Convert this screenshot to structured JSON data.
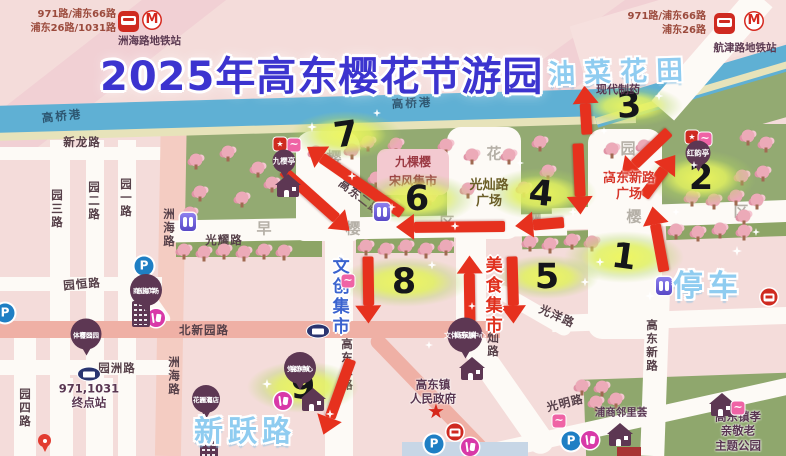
{
  "header": {
    "title": "2025年高东樱花节游园",
    "overlay_title": "油菜花田",
    "factory": "现代制药",
    "left_transit": {
      "line1": "971路/浦东66路",
      "line2": "浦东26路/1031路",
      "station": "洲海路地铁站"
    },
    "right_transit": {
      "line1": "971路/浦东66路",
      "line2": "浦东26路",
      "station": "航津路地铁站"
    }
  },
  "map": {
    "big_labels": [
      {
        "text": "停车",
        "x": 708,
        "y": 283,
        "size": 30
      },
      {
        "text": "新跃路",
        "x": 245,
        "y": 429,
        "size": 29
      }
    ],
    "river_labels": [
      {
        "text": "高桥港",
        "x": 62,
        "y": 116,
        "rot": -6
      },
      {
        "text": "高桥港",
        "x": 412,
        "y": 103,
        "rot": -3
      }
    ],
    "road_labels": [
      {
        "text": "新龙路",
        "x": 82,
        "y": 142
      },
      {
        "text": "园三路",
        "x": 57,
        "y": 209,
        "vertical": true
      },
      {
        "text": "园二路",
        "x": 94,
        "y": 201,
        "vertical": true
      },
      {
        "text": "园一路",
        "x": 126,
        "y": 198,
        "vertical": true
      },
      {
        "text": "洲海路",
        "x": 169,
        "y": 228,
        "vertical": true
      },
      {
        "text": "洲海路",
        "x": 174,
        "y": 376,
        "vertical": true
      },
      {
        "text": "光耀路",
        "x": 224,
        "y": 240
      },
      {
        "text": "园恒路",
        "x": 82,
        "y": 284,
        "rot": -5
      },
      {
        "text": "北新园路",
        "x": 204,
        "y": 330
      },
      {
        "text": "园洲路",
        "x": 117,
        "y": 368
      },
      {
        "text": "园四路",
        "x": 25,
        "y": 408,
        "vertical": true
      },
      {
        "text": "高东二路",
        "x": 360,
        "y": 197,
        "rot": 38
      },
      {
        "text": "高东二路",
        "x": 347,
        "y": 365,
        "vertical": true
      },
      {
        "text": "光灿路",
        "x": 493,
        "y": 338,
        "vertical": true
      },
      {
        "text": "光洋路",
        "x": 557,
        "y": 316,
        "rot": 24
      },
      {
        "text": "光明路",
        "x": 565,
        "y": 403,
        "rot": -14
      },
      {
        "text": "高东新路",
        "x": 652,
        "y": 346,
        "vertical": true
      }
    ],
    "place_labels": [
      {
        "lines": [
          "光灿路",
          "广场"
        ],
        "x": 489,
        "y": 194,
        "cls": "olive"
      },
      {
        "lines": [
          "高东新路",
          "广场"
        ],
        "x": 629,
        "y": 187,
        "cls": "redp"
      },
      {
        "lines": [
          "高东镇",
          "人民政府"
        ],
        "x": 433,
        "y": 392,
        "cls": "plum"
      },
      {
        "lines": [
          "浦商邻里荟"
        ],
        "x": 621,
        "y": 413,
        "cls": "plum-sm"
      },
      {
        "lines": [
          "高东镇孝亲敬老",
          "主题公园"
        ],
        "x": 738,
        "y": 431,
        "cls": "plum"
      },
      {
        "lines": [
          "971,1031",
          "终点站"
        ],
        "x": 89,
        "y": 396,
        "cls": "plum"
      },
      {
        "lines": [
          "文创集市"
        ],
        "x": 338,
        "y": 297,
        "cls": "market market-blue",
        "vertical": true
      },
      {
        "lines": [
          "美食集市"
        ],
        "x": 491,
        "y": 296,
        "cls": "market market-red",
        "vertical": true
      }
    ],
    "deco_chars": [
      {
        "ch": "樱",
        "x": 334,
        "y": 157
      },
      {
        "ch": "花",
        "x": 494,
        "y": 153
      },
      {
        "ch": "园",
        "x": 628,
        "y": 148
      },
      {
        "ch": "早",
        "x": 264,
        "y": 228
      },
      {
        "ch": "樱",
        "x": 353,
        "y": 228
      },
      {
        "ch": "区",
        "x": 447,
        "y": 222
      },
      {
        "ch": "樱",
        "x": 534,
        "y": 220
      },
      {
        "ch": "樱",
        "x": 634,
        "y": 216
      },
      {
        "ch": "区",
        "x": 741,
        "y": 211
      }
    ],
    "market_box": {
      "lines": [
        "九棵樱",
        "宋风集市"
      ],
      "x": 413,
      "y": 172
    },
    "bubbles": [
      {
        "lines": [
          "东海岸",
          "商业广场"
        ],
        "x": 146,
        "y": 290,
        "d": 32
      },
      {
        "lines": [
          "樱园",
          "体育公园"
        ],
        "x": 86,
        "y": 334,
        "d": 31
      },
      {
        "lines": [
          "高东镇",
          "党群中心"
        ],
        "x": 300,
        "y": 368,
        "d": 32
      },
      {
        "lines": [
          "高东镇",
          "文体活动中心"
        ],
        "x": 465,
        "y": 335,
        "d": 35
      },
      {
        "lines": [
          "洲海",
          "花园酒店"
        ],
        "x": 206,
        "y": 399,
        "d": 28
      },
      {
        "lines": [
          "红韵亭"
        ],
        "x": 698,
        "y": 153,
        "d": 25
      },
      {
        "lines": [
          "九樱亭"
        ],
        "x": 284,
        "y": 161,
        "d": 23
      }
    ],
    "route_markers": [
      {
        "n": "1",
        "x": 624,
        "y": 257,
        "rot": 8,
        "gw": 120,
        "gh": 52
      },
      {
        "n": "2",
        "x": 701,
        "y": 178,
        "rot": 0,
        "gw": 110,
        "gh": 56
      },
      {
        "n": "3",
        "x": 629,
        "y": 106,
        "rot": -4,
        "gw": 108,
        "gh": 42
      },
      {
        "n": "4",
        "x": 541,
        "y": 194,
        "rot": 6,
        "gw": 112,
        "gh": 52
      },
      {
        "n": "5",
        "x": 547,
        "y": 277,
        "rot": 0,
        "gw": 104,
        "gh": 44
      },
      {
        "n": "6",
        "x": 417,
        "y": 199,
        "rot": 0,
        "gw": 118,
        "gh": 52
      },
      {
        "n": "7",
        "x": 346,
        "y": 135,
        "rot": -8,
        "gw": 112,
        "gh": 48
      },
      {
        "n": "8",
        "x": 404,
        "y": 282,
        "rot": 0,
        "gw": 132,
        "gh": 50
      },
      {
        "n": "9",
        "x": 303,
        "y": 387,
        "rot": 0,
        "gw": 112,
        "gh": 52
      }
    ],
    "route_arrows": [
      {
        "x1": 402,
        "y1": 213,
        "x2": 307,
        "y2": 147
      },
      {
        "x1": 283,
        "y1": 170,
        "x2": 350,
        "y2": 230
      },
      {
        "x1": 505,
        "y1": 226,
        "x2": 396,
        "y2": 227
      },
      {
        "x1": 587,
        "y1": 134,
        "x2": 584,
        "y2": 85
      },
      {
        "x1": 578,
        "y1": 143,
        "x2": 581,
        "y2": 214
      },
      {
        "x1": 564,
        "y1": 222,
        "x2": 515,
        "y2": 226
      },
      {
        "x1": 669,
        "y1": 131,
        "x2": 621,
        "y2": 177
      },
      {
        "x1": 644,
        "y1": 196,
        "x2": 675,
        "y2": 154
      },
      {
        "x1": 664,
        "y1": 271,
        "x2": 652,
        "y2": 206
      },
      {
        "x1": 368,
        "y1": 256,
        "x2": 369,
        "y2": 323
      },
      {
        "x1": 470,
        "y1": 326,
        "x2": 469,
        "y2": 255
      },
      {
        "x1": 512,
        "y1": 256,
        "x2": 514,
        "y2": 323
      },
      {
        "x1": 351,
        "y1": 359,
        "x2": 324,
        "y2": 434
      }
    ],
    "icons": [
      {
        "name": "toilet",
        "x": 382,
        "y": 212
      },
      {
        "name": "toilet",
        "x": 188,
        "y": 222
      },
      {
        "name": "toilet",
        "x": 664,
        "y": 286
      },
      {
        "name": "parking",
        "x": 144,
        "y": 266
      },
      {
        "name": "parking",
        "x": 5,
        "y": 313
      },
      {
        "name": "parking",
        "x": 434,
        "y": 444
      },
      {
        "name": "parking",
        "x": 571,
        "y": 441
      },
      {
        "name": "food",
        "x": 156,
        "y": 318
      },
      {
        "name": "food",
        "x": 283,
        "y": 401
      },
      {
        "name": "food",
        "x": 470,
        "y": 447
      },
      {
        "name": "food",
        "x": 590,
        "y": 440
      },
      {
        "name": "house",
        "x": 288,
        "y": 186
      },
      {
        "name": "house",
        "x": 313,
        "y": 400
      },
      {
        "name": "house",
        "x": 472,
        "y": 369
      },
      {
        "name": "house",
        "x": 620,
        "y": 435
      },
      {
        "name": "house",
        "x": 722,
        "y": 405
      },
      {
        "name": "building",
        "x": 141,
        "y": 314
      },
      {
        "name": "building",
        "x": 209,
        "y": 449
      },
      {
        "name": "flag",
        "x": 280,
        "y": 144
      },
      {
        "name": "flag",
        "x": 692,
        "y": 137
      },
      {
        "name": "sakura-logo",
        "x": 294,
        "y": 145
      },
      {
        "name": "sakura-logo",
        "x": 705,
        "y": 139
      },
      {
        "name": "sakura-logo",
        "x": 348,
        "y": 281
      },
      {
        "name": "sakura-logo",
        "x": 559,
        "y": 421
      },
      {
        "name": "sakura-logo",
        "x": 738,
        "y": 408
      },
      {
        "name": "bus-stop",
        "x": 455,
        "y": 432
      },
      {
        "name": "bus-stop",
        "x": 769,
        "y": 297
      },
      {
        "name": "bus-oval",
        "x": 89,
        "y": 374
      },
      {
        "name": "bus-oval",
        "x": 318,
        "y": 331
      },
      {
        "name": "star",
        "x": 436,
        "y": 411
      },
      {
        "name": "pin",
        "x": 45,
        "y": 444
      }
    ]
  }
}
